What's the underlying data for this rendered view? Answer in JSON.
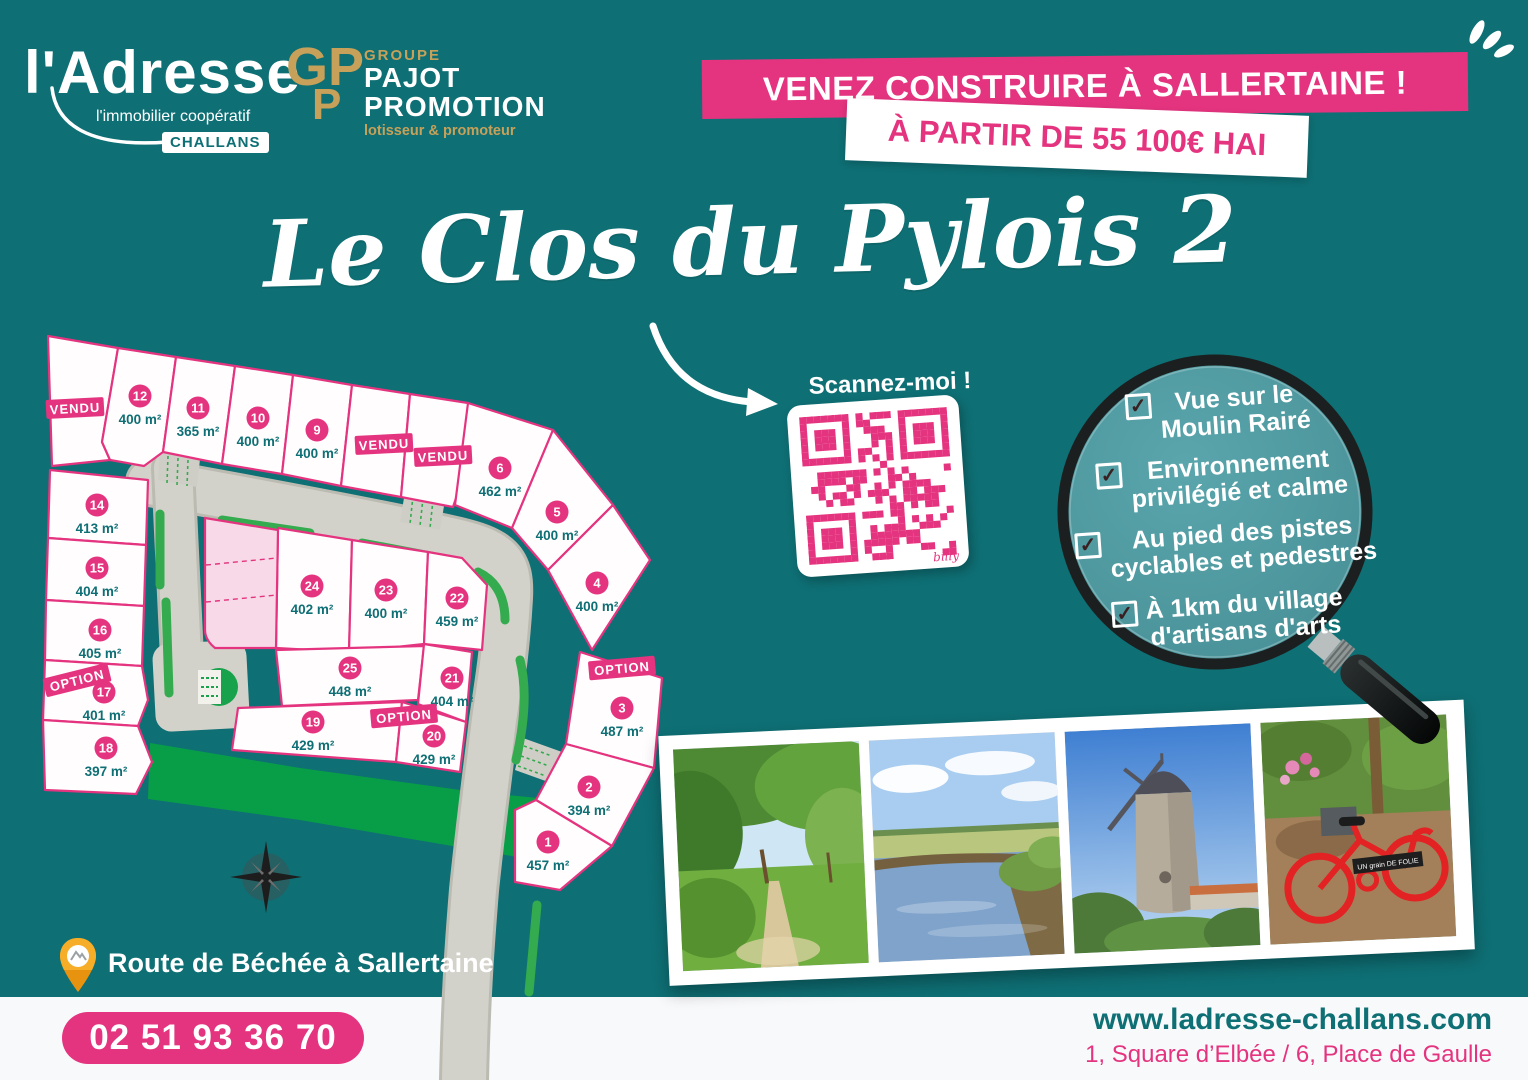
{
  "brand": {
    "name": "l'Adresse",
    "tagline": "l'immobilier coopératif",
    "city": "CHALLANS"
  },
  "pajot": {
    "monogram_top": "GP",
    "monogram_bottom": "P",
    "group": "GROUPE",
    "line1": "PAJOT",
    "line2": "PROMOTION",
    "tagline": "lotisseur & promoteur"
  },
  "banners": {
    "main": "VENEZ CONSTRUIRE À SALLERTAINE !",
    "price": "À PARTIR DE 55 100€ HAI"
  },
  "title": "Le Clos du Pylois 2",
  "qr": {
    "label": "Scannez-moi !",
    "signature": "billy"
  },
  "features": [
    {
      "line1": "Vue sur le",
      "line2": "Moulin Rairé"
    },
    {
      "line1": "Environnement",
      "line2": "privilégié et calme"
    },
    {
      "line1": "Au pied des pistes",
      "line2": "cyclables et pedestres"
    },
    {
      "line1": "À 1km du village",
      "line2": "d'artisans d'arts"
    }
  ],
  "map": {
    "lots": [
      {
        "num": "1",
        "area": "457 m²",
        "x": 548,
        "y": 842
      },
      {
        "num": "2",
        "area": "394 m²",
        "x": 589,
        "y": 787
      },
      {
        "num": "3",
        "area": "487 m²",
        "x": 622,
        "y": 708
      },
      {
        "num": "4",
        "area": "400 m²",
        "x": 597,
        "y": 583
      },
      {
        "num": "5",
        "area": "400 m²",
        "x": 557,
        "y": 512
      },
      {
        "num": "6",
        "area": "462 m²",
        "x": 500,
        "y": 468
      },
      {
        "num": "9",
        "area": "400 m²",
        "x": 317,
        "y": 430
      },
      {
        "num": "10",
        "area": "400 m²",
        "x": 258,
        "y": 418
      },
      {
        "num": "11",
        "area": "365 m²",
        "x": 198,
        "y": 408
      },
      {
        "num": "12",
        "area": "400 m²",
        "x": 140,
        "y": 396
      },
      {
        "num": "14",
        "area": "413 m²",
        "x": 97,
        "y": 505
      },
      {
        "num": "15",
        "area": "404 m²",
        "x": 97,
        "y": 568
      },
      {
        "num": "16",
        "area": "405 m²",
        "x": 100,
        "y": 630
      },
      {
        "num": "17",
        "area": "401 m²",
        "x": 104,
        "y": 692
      },
      {
        "num": "18",
        "area": "397 m²",
        "x": 106,
        "y": 748
      },
      {
        "num": "19",
        "area": "429 m²",
        "x": 313,
        "y": 722
      },
      {
        "num": "20",
        "area": "429 m²",
        "x": 434,
        "y": 736
      },
      {
        "num": "21",
        "area": "404 m²",
        "x": 452,
        "y": 678
      },
      {
        "num": "22",
        "area": "459 m²",
        "x": 457,
        "y": 598
      },
      {
        "num": "23",
        "area": "400 m²",
        "x": 386,
        "y": 590
      },
      {
        "num": "24",
        "area": "402 m²",
        "x": 312,
        "y": 586
      },
      {
        "num": "25",
        "area": "448 m²",
        "x": 350,
        "y": 668
      }
    ],
    "status_labels": [
      {
        "text": "VENDU",
        "x": 75,
        "y": 408,
        "rot": -3
      },
      {
        "text": "VENDU",
        "x": 384,
        "y": 444,
        "rot": -3
      },
      {
        "text": "VENDU",
        "x": 443,
        "y": 456,
        "rot": -3
      },
      {
        "text": "OPTION",
        "x": 77,
        "y": 680,
        "rot": -14
      },
      {
        "text": "OPTION",
        "x": 404,
        "y": 716,
        "rot": -5
      },
      {
        "text": "OPTION",
        "x": 622,
        "y": 668,
        "rot": -5
      }
    ]
  },
  "photos": [
    {
      "name": "chemin pédestre"
    },
    {
      "name": "rivière"
    },
    {
      "name": "moulin Rairé"
    },
    {
      "name": "vélo rouge",
      "sign": "UN grain DE FOLIE"
    }
  ],
  "contact": {
    "location": "Route de Béchée à Sallertaine",
    "phone": "02 51 93 36 70",
    "website": "www.ladresse-challans.com",
    "addresses": "1, Square d’Elbée / 6, Place de Gaulle"
  },
  "colors": {
    "teal": "#0e6f74",
    "pink": "#e5347f",
    "gold": "#c7a159",
    "road": "#d3d2ca",
    "green": "#33ab4e",
    "hedge": "#089e48"
  }
}
